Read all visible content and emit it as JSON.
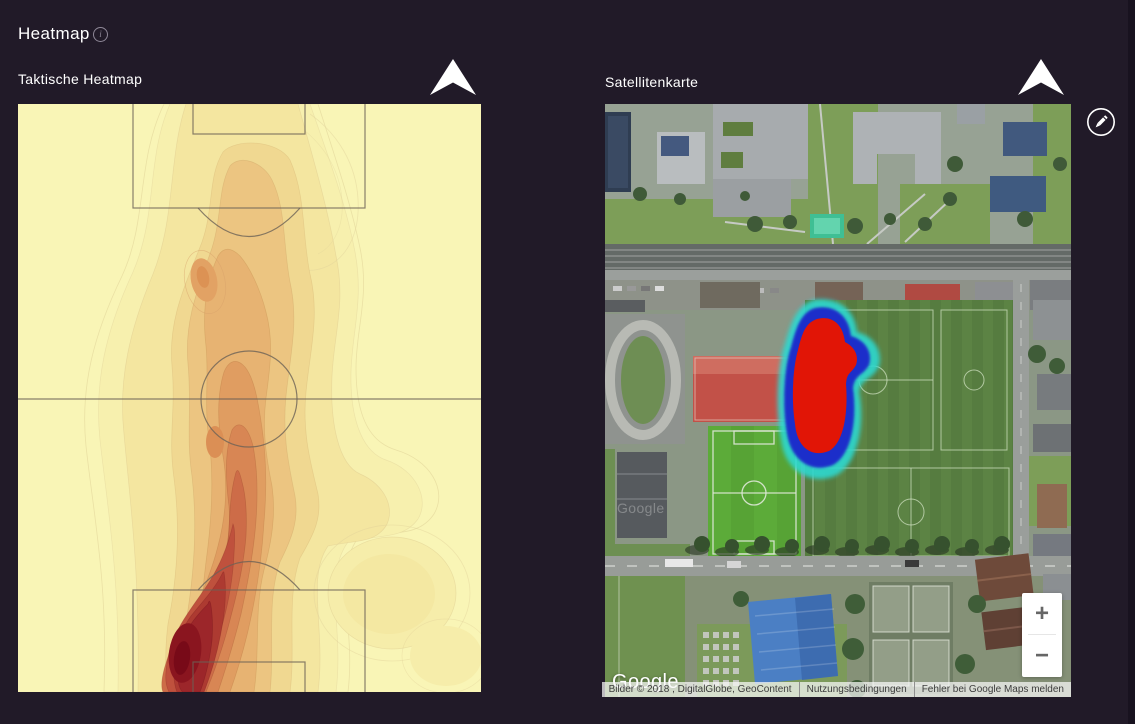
{
  "page": {
    "title": "Heatmap",
    "background_color": "#211a28"
  },
  "panels": {
    "tactical": {
      "title": "Taktische Heatmap"
    },
    "satellite": {
      "title": "Satellitenkarte"
    }
  },
  "field": {
    "background_color": "#f9f5b6",
    "line_color": "#6b6156"
  },
  "chart_data": {
    "type": "heatmap",
    "title": "Taktische Heatmap",
    "surface": "football-pitch-vertical",
    "colormap": "YlOrRd",
    "colormap_stops": [
      "#f9f5b6",
      "#f7f0ae",
      "#f4e6a0",
      "#f0d891",
      "#ecc581",
      "#e7b372",
      "#e09d61",
      "#d88654",
      "#cd6c48",
      "#bf513d",
      "#ad3a31",
      "#9c262a",
      "#8a151f",
      "#780a18"
    ],
    "legend": "none",
    "hotspots": [
      {
        "x_pct": 35,
        "y_pct": 93,
        "intensity": 1.0,
        "note": "maximum, inside lower penalty area left"
      },
      {
        "x_pct": 47,
        "y_pct": 68,
        "intensity": 0.55,
        "note": "ridge below centre circle"
      },
      {
        "x_pct": 40,
        "y_pct": 29,
        "intensity": 0.4,
        "note": "local maximum upper half"
      },
      {
        "x_pct": 50,
        "y_pct": 17,
        "intensity": 0.3,
        "note": "lobe at upper penalty box"
      },
      {
        "x_pct": 81,
        "y_pct": 83,
        "intensity": 0.1,
        "note": "faint blob right side"
      }
    ]
  },
  "map": {
    "overlay": {
      "core_color": "#e11506",
      "ring_color": "#1d2fca",
      "glow_color": "#2fd8cf"
    },
    "controls": {
      "zoom_in": "+",
      "zoom_out": "−"
    },
    "google_logo": "Google",
    "watermark": "Google",
    "attribution": {
      "imagery": "Bilder © 2018 , DigitalGlobe, GeoContent",
      "terms": "Nutzungsbedingungen",
      "report": "Fehler bei Google Maps melden"
    }
  }
}
